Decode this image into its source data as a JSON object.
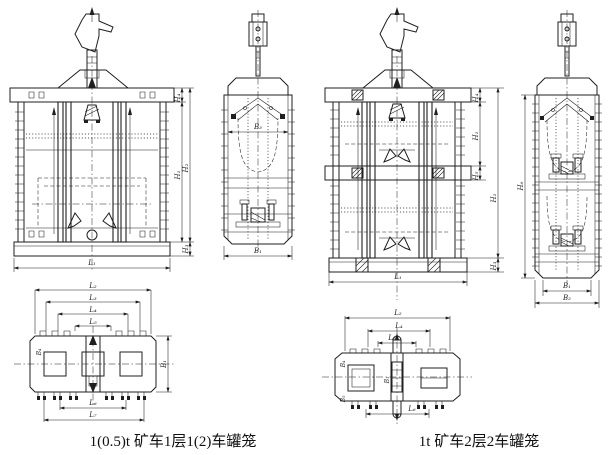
{
  "background": "#ffffff",
  "line_color": "#1f1f1f",
  "captions": {
    "left": "1(0.5)t 矿车1层1(2)车罐笼",
    "right": "1t 矿车2层2车罐笼"
  },
  "left_group": {
    "front_view": {
      "dim_labels": {
        "top": "H₄",
        "inner": "H₁",
        "overall": "H₂",
        "base": "H₃",
        "length": "L₁"
      }
    },
    "side_view": {
      "dim_labels": {
        "inner_width": "B₃",
        "width": "B₁"
      }
    },
    "plan_view": {
      "dim_labels": {
        "top": [
          "L₂",
          "L₃",
          "L₄",
          "L₅"
        ],
        "bottom": [
          "L₆",
          "L₇"
        ],
        "width": "B₁",
        "detail": "B₄"
      }
    }
  },
  "right_group": {
    "front_view": {
      "dim_labels": {
        "top": "H₄",
        "deck": "H₁",
        "mid": "H₅",
        "overall": "H₂",
        "base": "H₃",
        "length": "L₁"
      }
    },
    "side_view": {
      "dim_labels": {
        "height": "H₆",
        "inner_width": "B₁",
        "width": "B₂"
      }
    },
    "plan_view": {
      "dim_labels": {
        "top": [
          "L₂",
          "L₄",
          "L₅"
        ],
        "bottom": [
          "L₆"
        ],
        "center": "B₁",
        "detail_top": "B₄",
        "detail_bottom": "B₅"
      }
    }
  }
}
